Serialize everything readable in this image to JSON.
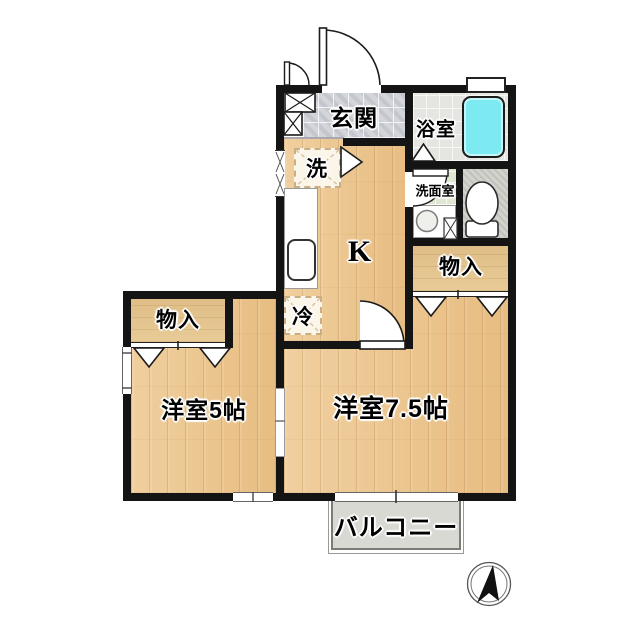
{
  "floorplan": {
    "labels": {
      "entrance": "玄関",
      "bathroom": "浴室",
      "washroom": "洗面室",
      "washer": "洗",
      "kitchen": "K",
      "fridge": "冷",
      "closet_right": "物入",
      "closet_left": "物入",
      "room_5": "洋室5帖",
      "room_75": "洋室7.5帖",
      "balcony": "バルコニー"
    },
    "colors": {
      "wall": "#141414",
      "wood_floor": "#ecc794",
      "closet_floor": "#e4c692",
      "entrance_tile": "#d3d5db",
      "bath_floor": "#e5e5e1",
      "washroom_floor": "#dfe6d2",
      "toilet_floor": "#d3d3cd",
      "bathtub": "#7de9f0",
      "balcony_floor": "#d9d9d3"
    },
    "icons": {
      "compass": "north-arrow"
    }
  }
}
